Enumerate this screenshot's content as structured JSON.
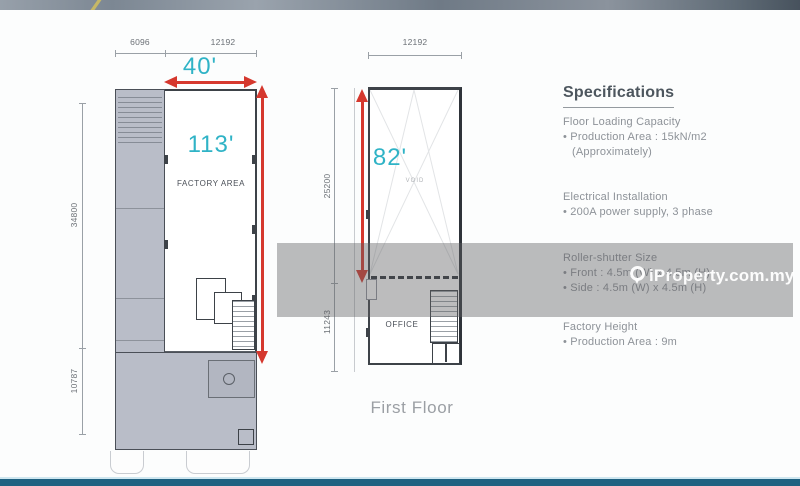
{
  "watermark": {
    "text": "iProperty.com.my"
  },
  "ground_floor_plan": {
    "dim_top_left": "6096",
    "dim_top_right": "12192",
    "dim_side_upper": "34800",
    "dim_side_lower": "10787",
    "width_label": "40'",
    "length_label": "113'",
    "room_label": "FACTORY AREA"
  },
  "first_floor_plan": {
    "dim_top": "12192",
    "dim_side_upper": "25200",
    "dim_side_lower": "11243",
    "length_label": "82'",
    "room_label": "OFFICE",
    "void_label": "VOID",
    "caption": "First Floor"
  },
  "specifications": {
    "title": "Specifications",
    "sections": [
      {
        "heading": "Floor Loading Capacity",
        "lines": [
          "• Production Area : 15kN/m2",
          "(Approximately)"
        ]
      },
      {
        "heading": "Electrical Installation",
        "lines": [
          "• 200A power supply, 3 phase"
        ]
      },
      {
        "heading": "Roller-shutter Size",
        "lines": [
          "• Front : 4.5m (W) x 4.5m (H)",
          "• Side : 4.5m (W) x 4.5m (H)"
        ]
      },
      {
        "heading": "Factory Height",
        "lines": [
          "• Production Area : 9m"
        ]
      }
    ]
  },
  "colors": {
    "accent_cyan": "#2fb3c6",
    "arrow_red": "#d5382e",
    "plan_fill": "#b9bdc8",
    "footer_teal": "#1f6181"
  }
}
